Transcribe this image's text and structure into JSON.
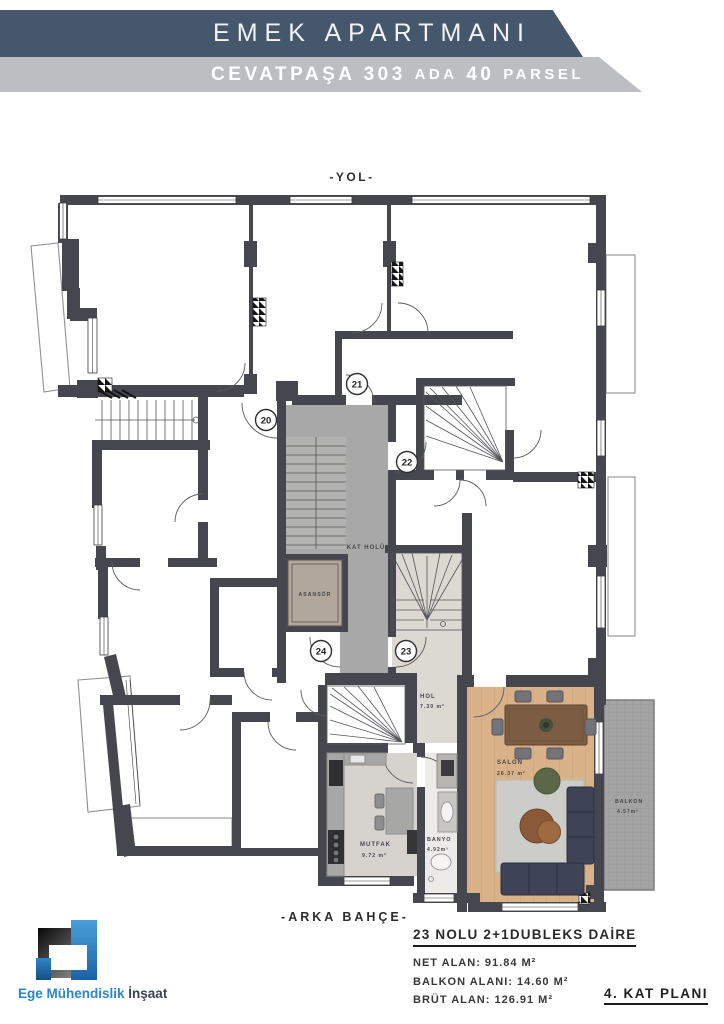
{
  "header": {
    "title": "EMEK APARTMANI",
    "subtitle": {
      "p1": "CEVATPAŞA 303",
      "p2": "ADA",
      "p3": "40",
      "p4": "PARSEL"
    },
    "bar_dark_color": "#45586b",
    "bar_light_color": "#bcbec1"
  },
  "plan": {
    "street_label": "-YOL-",
    "garden_label": "-ARKA BAHÇE-",
    "rooms": {
      "kat_holu": "KAT HOLÜ",
      "asansor": "ASANSÖR",
      "hol_name": "HOL",
      "hol_area": "7.30 m²",
      "salon_name": "SALON",
      "salon_area": "26.37 m²",
      "mutfak_name": "MUTFAK",
      "mutfak_area": "9.72 m²",
      "banyo_name": "BANYO",
      "banyo_area": "4.92m²",
      "balkon_name": "BALKON",
      "balkon_area": "4.57m²"
    },
    "door_numbers": [
      "20",
      "21",
      "22",
      "23",
      "24"
    ]
  },
  "info": {
    "apartment_title": "23 NOLU 2+1DUBLEKS DAİRE",
    "net_line": "NET ALAN: 91.84 M²",
    "balkon_line": "BALKON ALANI: 14.60 M²",
    "brut_line": "BRÜT ALAN: 126.91 M²",
    "floor_label": "4. KAT PLANI"
  },
  "logo": {
    "name_blue": "Ege Mühendislik",
    "name_dark": "İnşaat",
    "brand_blue": "#2a86c6"
  }
}
